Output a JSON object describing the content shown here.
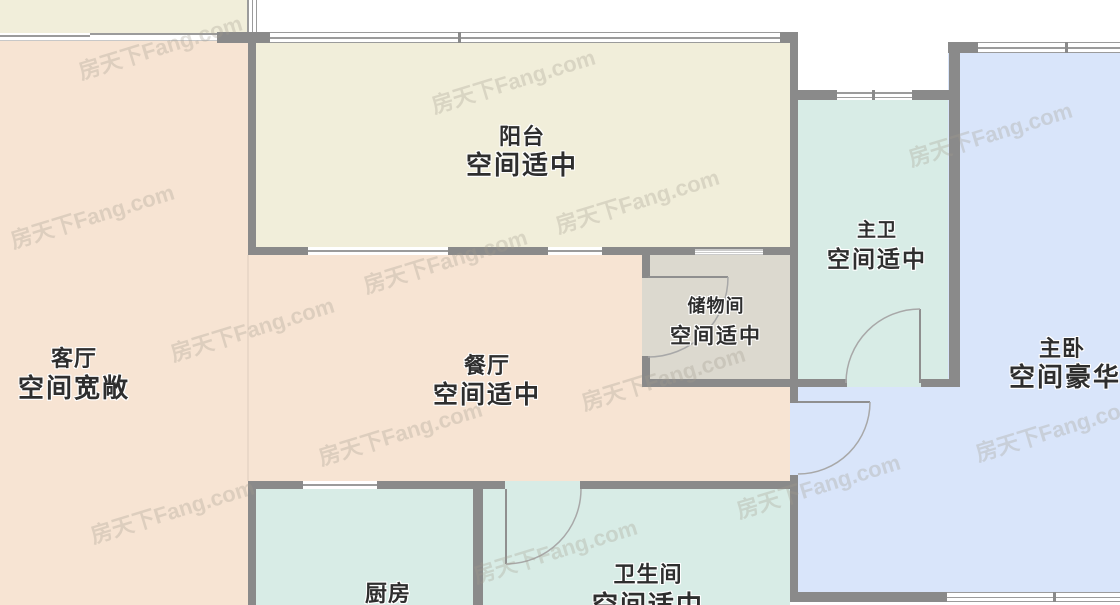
{
  "watermark": {
    "text": "房天下Fang.com"
  },
  "colors": {
    "living-dining-fill": "#f7e4d3",
    "balcony-fill": "#f1eeda",
    "wet-room-fill": "#d8ece6",
    "bedroom-fill": "#d9e5fa",
    "storage-fill": "#dcd9cf",
    "wall": "#8a8a8a",
    "window-line": "#9b9b9b",
    "label-text": "#2e2e2e"
  },
  "rooms": {
    "balcony": {
      "name": "阳台",
      "assessment": "空间适中"
    },
    "living": {
      "name": "客厅",
      "assessment": "空间宽敞"
    },
    "dining": {
      "name": "餐厅",
      "assessment": "空间适中"
    },
    "storage": {
      "name": "储物间",
      "assessment": "空间适中"
    },
    "master_bath": {
      "name": "主卫",
      "assessment": "空间适中"
    },
    "master_bed": {
      "name": "主卧",
      "assessment": "空间豪华"
    },
    "kitchen": {
      "name": "厨房"
    },
    "bathroom": {
      "name": "卫生间",
      "assessment": "空间适中"
    }
  }
}
